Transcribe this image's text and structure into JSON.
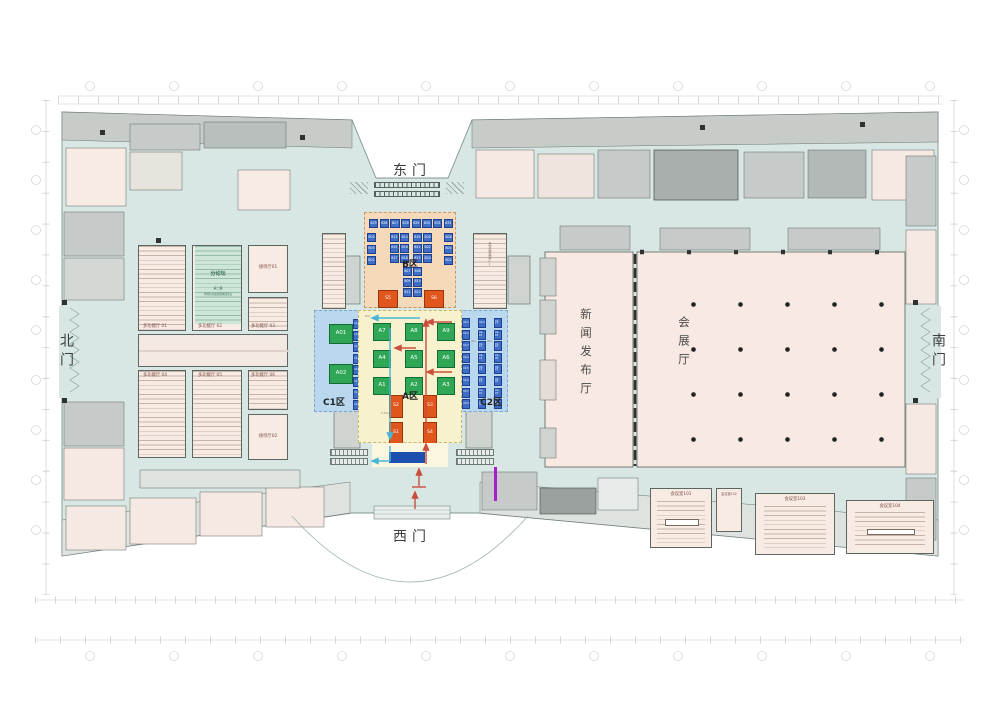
{
  "colors": {
    "concourse": "#d8e7e4",
    "room_pink": "#f8ebe4",
    "room_gray": "#c6cbc9",
    "panel_b": "#f4d9ba",
    "panel_a": "#f7f2cd",
    "panel_c": "#b9d8ee",
    "booth_green": "#2fa757",
    "booth_blue": "#3e6ec6",
    "booth_orange": "#e0561d",
    "forum_green": "#cde6d8",
    "arrow_in_red": "#c94f3c",
    "arrow_out_cyan": "#49b6d6",
    "desk_blue": "#1d4fae",
    "purple_marker": "#a81fc9"
  },
  "gates": {
    "east": "东门",
    "west": "西门",
    "north": "北门",
    "south": "南门"
  },
  "zones": {
    "a": {
      "label": "A区",
      "dim_top": "5m",
      "dim_mid": "1.5m",
      "green": [
        "A7",
        "A8",
        "A9",
        "A4",
        "A5",
        "A6",
        "A1",
        "A2",
        "A3"
      ],
      "orange": [
        "S2",
        "S3",
        "S1",
        "S4"
      ]
    },
    "b": {
      "label": "B区",
      "top_row": [
        "B25",
        "B26",
        "B27",
        "B28",
        "B29",
        "B30",
        "B31",
        "B32"
      ],
      "left_col": [
        "B05",
        "B03",
        "B01"
      ],
      "right_col": [
        "B06",
        "B04",
        "B02"
      ],
      "mid_left": [
        "B13",
        "B14",
        "B15",
        "B16",
        "B17",
        "B18"
      ],
      "mid_right": [
        "B19",
        "B20",
        "B21",
        "B22",
        "B23",
        "B24"
      ],
      "bottom": [
        "B07",
        "B08",
        "B09",
        "B10",
        "B11",
        "B12"
      ],
      "orange": [
        "S5",
        "S6"
      ]
    },
    "c1": {
      "label": "C1区",
      "green": [
        "A01",
        "A02"
      ],
      "strip": [
        "C1-1",
        "C1-2",
        "C1-3",
        "C1-4",
        "C1-5",
        "C1-6",
        "C1-7",
        "C1-8"
      ]
    },
    "c2": {
      "label": "C2区",
      "dim": "4m",
      "strip1": [
        "C2-1",
        "C2-2",
        "C2-3",
        "C2-4",
        "C2-5",
        "C2-6",
        "C2-7",
        "C2-8"
      ],
      "strip2": [
        "C2-9",
        "C2-10",
        "C2-11",
        "C2-12",
        "C2-13",
        "C2-14",
        "C2-15",
        "C2-16"
      ],
      "strip3": [
        "C2-17",
        "C2-18",
        "C2-19",
        "C2-20",
        "C2-21",
        "C2-22",
        "C2-23",
        "C2-24"
      ]
    }
  },
  "left_wing": {
    "halls": [
      "多功能厅 01",
      "多功能厅 02",
      "多功能厅 03",
      "多功能厅 04",
      "多功能厅 05",
      "多功能厅 06"
    ],
    "reception": [
      "接待厅01",
      "接待厅02"
    ],
    "forum": {
      "title": "分论坛",
      "sub1": "第二届",
      "sub2": "中国礼用品和器械展论坛"
    }
  },
  "right_wing": {
    "press_hall": "新闻发布厅",
    "expo_hall": "会展厅",
    "vip": "贵宾休息室07"
  },
  "meeting_rooms": [
    "会议室101",
    "会议室102",
    "会议室103",
    "会议室104"
  ]
}
